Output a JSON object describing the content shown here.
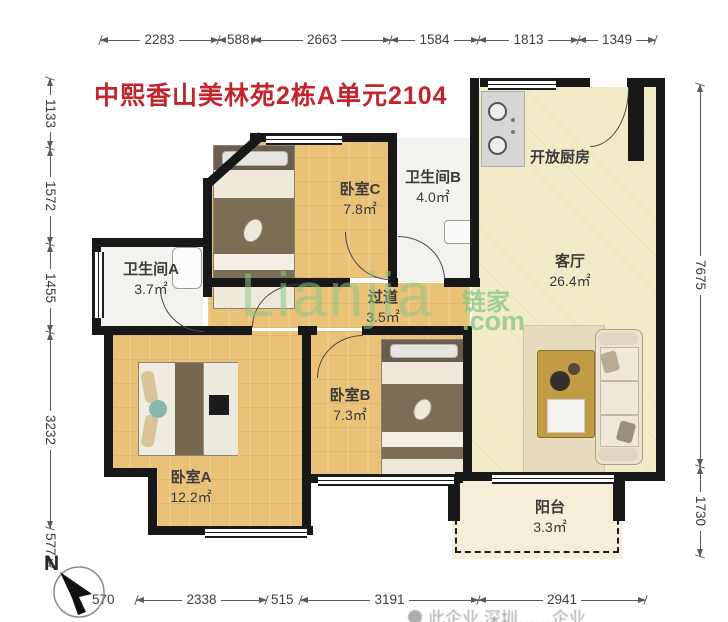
{
  "title": {
    "text": "中熙香山美林苑2栋A单元2104",
    "color": "#c2262c"
  },
  "dimensions": {
    "top": [
      "2283",
      "588",
      "2663",
      "1584",
      "1813",
      "1349"
    ],
    "left": [
      "1133",
      "1572",
      "1455",
      "3232",
      "577"
    ],
    "right": [
      "7675",
      "1730"
    ],
    "bottom": [
      "570",
      "2338",
      "515",
      "3191",
      "2941"
    ]
  },
  "rooms": {
    "kitchen": {
      "name": "开放厨房",
      "area": ""
    },
    "living": {
      "name": "客厅",
      "area": "26.4㎡"
    },
    "bedroomC": {
      "name": "卧室C",
      "area": "7.8㎡"
    },
    "bathB": {
      "name": "卫生间B",
      "area": "4.0㎡"
    },
    "bathA": {
      "name": "卫生间A",
      "area": "3.7㎡"
    },
    "hall": {
      "name": "过道",
      "area": "3.5㎡"
    },
    "bedroomB": {
      "name": "卧室B",
      "area": "7.3㎡"
    },
    "bedroomA": {
      "name": "卧室A",
      "area": "12.2㎡"
    },
    "balcony": {
      "name": "阳台",
      "area": "3.3㎡"
    }
  },
  "watermark": {
    "brand": "Lianjia",
    "cn": "链家",
    "domain": ".com",
    "color": "#8cc786"
  },
  "compass": {
    "label": "N"
  },
  "footer": {
    "partial_text": "此企业 深圳……企业"
  },
  "colors": {
    "wall": "#181818",
    "wood_floor": "#e9c277",
    "living_floor": "#f2ebc8",
    "bath_floor": "#f3f2ef",
    "title_red": "#c2262c",
    "watermark_green": "#8cc786"
  }
}
